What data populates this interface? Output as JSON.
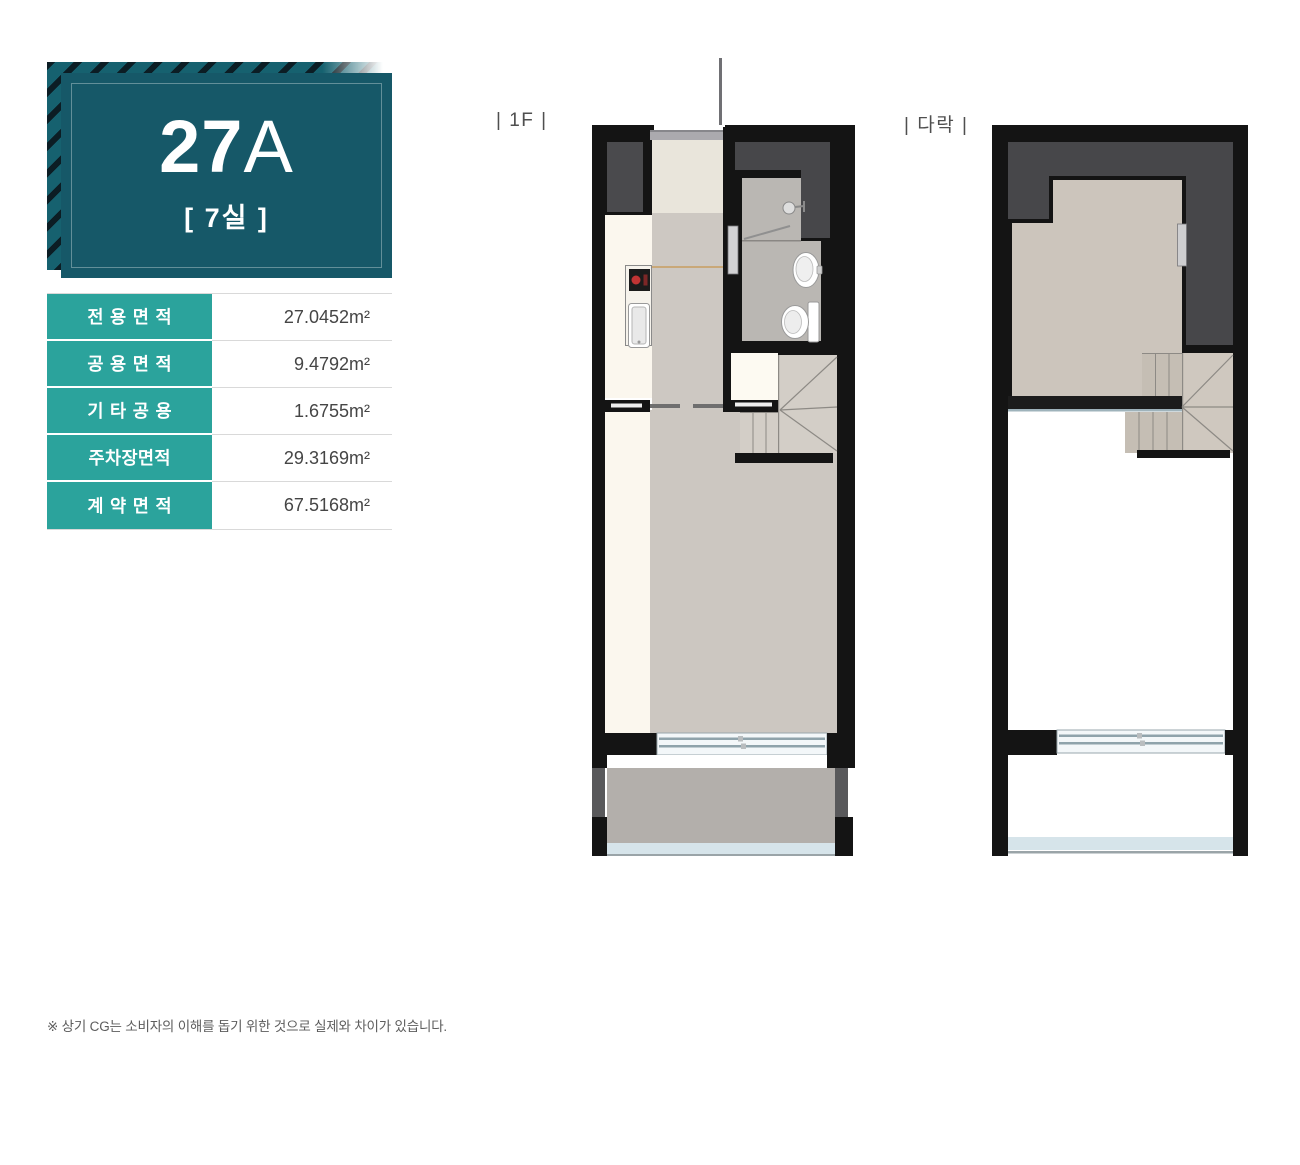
{
  "badge": {
    "unit_main": "27",
    "unit_suffix": "A",
    "rooms": "[ 7실 ]"
  },
  "area_table": {
    "rows": [
      {
        "label": "전용면적",
        "value": "27.0452",
        "unit": "m²"
      },
      {
        "label": "공용면적",
        "value": "9.4792",
        "unit": "m²"
      },
      {
        "label": "기타공용",
        "value": "1.6755",
        "unit": "m²"
      },
      {
        "label": "주차장면적",
        "value": "29.3169",
        "unit": "m²"
      },
      {
        "label": "계약면적",
        "value": "67.5168",
        "unit": "m²"
      }
    ]
  },
  "plans": {
    "first": {
      "label": "| 1F |"
    },
    "second": {
      "label": "| 다락 |"
    }
  },
  "footer": {
    "note": "※ 상기 CG는 소비자의 이해를 돕기 위한 것으로 실제와 차이가 있습니다."
  },
  "colors": {
    "badge_teal": "#165868",
    "badge_stripe": "#16616f",
    "table_teal": "#2ba39c"
  }
}
